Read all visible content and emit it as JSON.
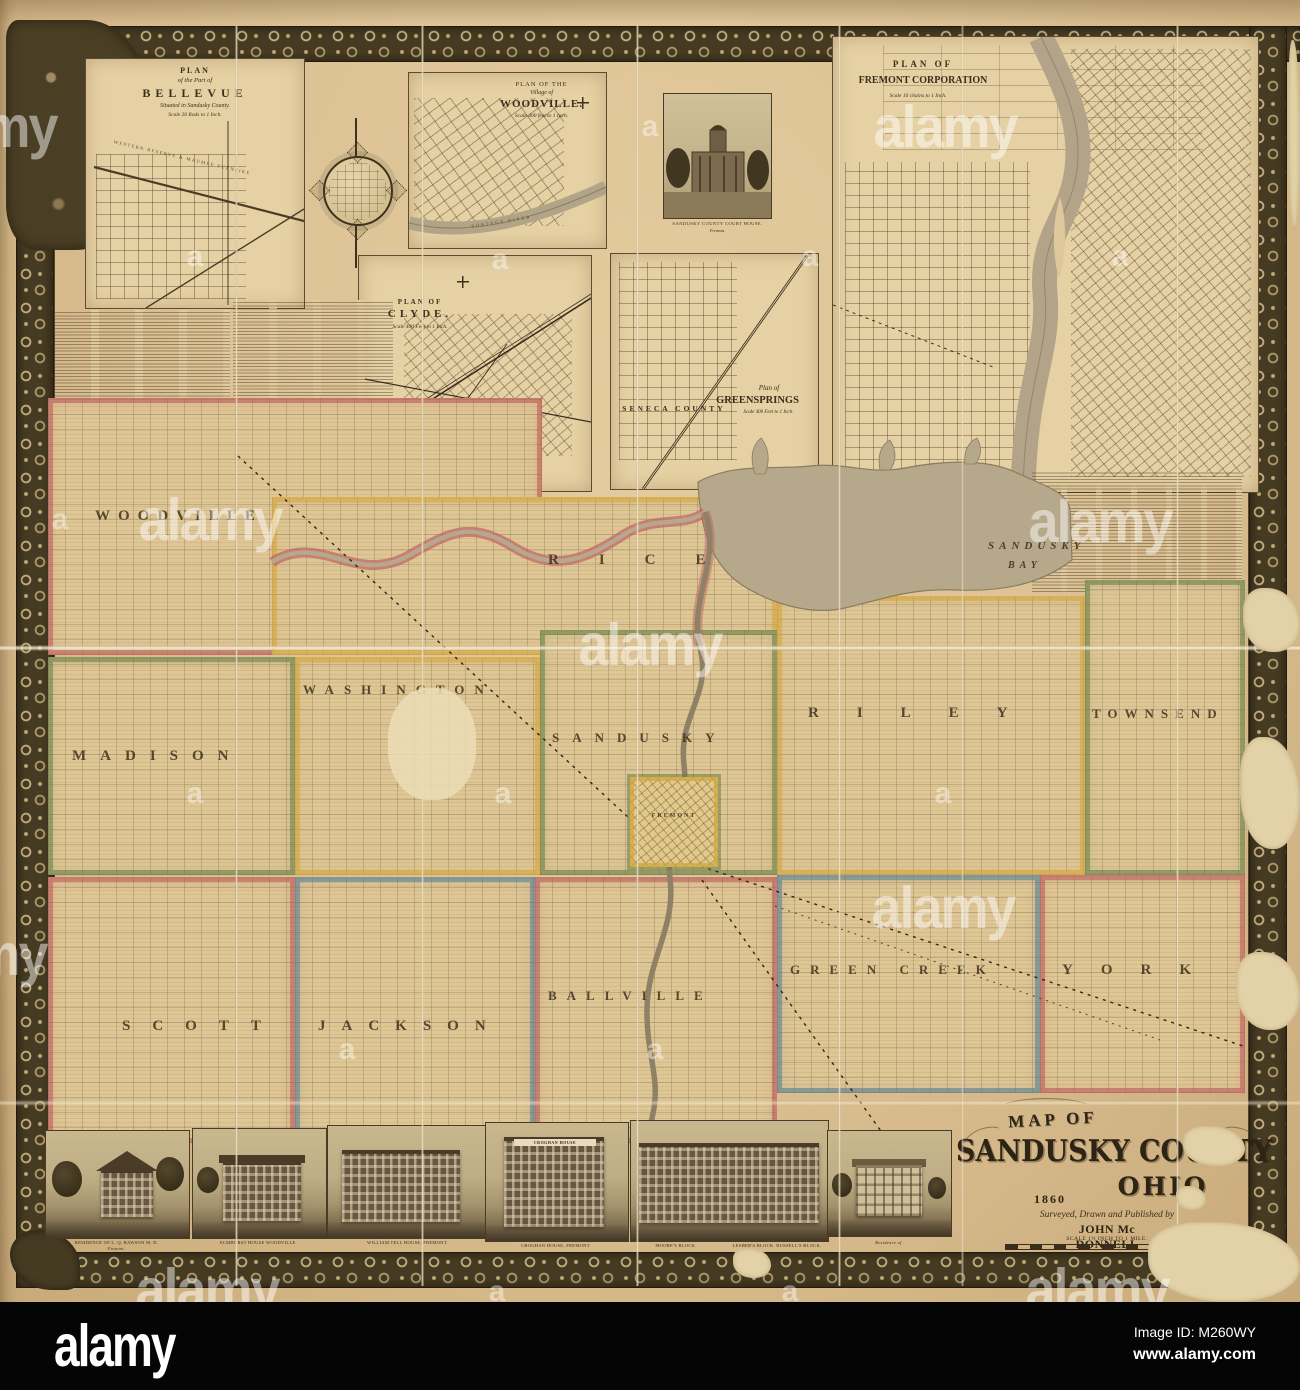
{
  "alamy_bar": {
    "logo": "alamy",
    "image_id": "Image ID: M260WY",
    "website": "www.alamy.com"
  },
  "watermarks": {
    "large": "alamy",
    "small": "a"
  },
  "cartouche": {
    "map_of": "MAP OF",
    "county": "SANDUSKY COUNTY",
    "state": "OHIO",
    "year": "1860",
    "byline": "Surveyed, Drawn and Published by",
    "publisher": "JOHN Mc DONNELL",
    "scale": "SCALE 1½ INCH TO 1 MILE."
  },
  "insets": {
    "bellevue": {
      "t1": "PLAN",
      "t2": "of the Part of",
      "t3": "BELLEVUE",
      "t4": "Situated in Sandusky County.",
      "t5": "Scale 20 Rods to 1 Inch.",
      "road": "WESTERN RESERVE & MAUMEE TURNPIKE"
    },
    "woodville": {
      "t1": "PLAN OF THE",
      "t2": "Village of",
      "t3": "WOODVILLE.",
      "t4": "Scale 400 feet to 1 Inch.",
      "river": "PORTAGE RIVER"
    },
    "clyde": {
      "t1": "PLAN OF",
      "t2": "CLYDE.",
      "t3": "Scale 400 Feet to 1 Inch."
    },
    "greensprings": {
      "t1": "Plan of",
      "t2": "GREENSPRINGS",
      "t3": "Scale 400 Feet to 1 Inch.",
      "county": "SENECA COUNTY"
    },
    "fremont": {
      "t1": "PLAN OF",
      "t2": "FREMONT CORPORATION",
      "t3": "Scale 16 chains to 1 Inch."
    }
  },
  "courthouse": {
    "caption1": "SANDUSKY COUNTY COURT HOUSE.",
    "caption2": "Fremont."
  },
  "lithographer": {
    "l1": "W. H. REASE'S",
    "l2": "LITHOGRAPHIC ESTABLISHMENT",
    "l3": "N. E. Cor. 17th & Chestnut Sts.",
    "l4": "PHILADELPHIA."
  },
  "townships": {
    "woodville": "WOODVILLE",
    "rice": "RICE",
    "madison": "MADISON",
    "washington": "WASHINGTON",
    "sandusky": "SANDUSKY",
    "riley": "RILEY",
    "townsend": "TOWNSEND",
    "scott": "SCOTT",
    "jackson": "JACKSON",
    "ballville": "BALLVILLE",
    "greencreek": "GREEN CREEK",
    "york": "YORK"
  },
  "places": {
    "fremont_town": "FREMONT",
    "bay_line1": "SANDUSKY",
    "bay_line2": "BAY"
  },
  "vignettes": {
    "v1": "RESIDENCE OF L. Q. RAWSON M. D.",
    "v1b": "Fremont.",
    "v2": "ELMHURST HOUSE WOODVILLE.",
    "v3": "WILLIAM TELL HOUSE, FREMONT.",
    "v4": "CROGHAN HOUSE, FREMONT.",
    "v4sign": "CROGHAN HOUSE",
    "v5a": "MOORE'S BLOCK.",
    "v5b": "LESHER'S BLOCK.  BUSSELL'S BLOCK.",
    "v6": "Residence of"
  }
}
